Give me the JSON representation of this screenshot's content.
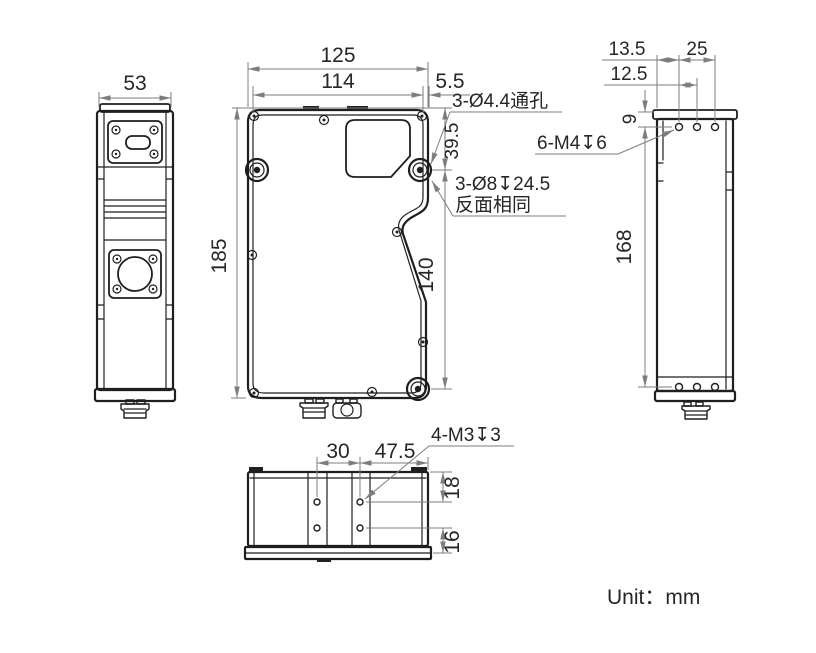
{
  "unit_label": "Unit：mm",
  "views": {
    "left": {
      "width": "53"
    },
    "front": {
      "overall_width": "125",
      "mount_hole_span": "114",
      "edge_to_hole": "5.5",
      "overall_height": "185",
      "top_to_hole": "39.5",
      "hole_span_vertical": "140",
      "callout_through_holes": "3-Ø4.4通孔",
      "callout_counterbore_line1": "3-Ø8↧24.5",
      "callout_counterbore_line2": "反面相同"
    },
    "right": {
      "edge_to_hole": "13.5",
      "hole_pitch": "12.5",
      "hole_span": "25",
      "top_to_hole": "9",
      "hole_span_vertical": "168",
      "callout_tapped": "6-M4↧6"
    },
    "bottom": {
      "hole_pitch": "30",
      "hole_to_edge": "47.5",
      "top_to_hole": "18",
      "hole_to_bottom": "16",
      "callout_tapped": "4-M3↧3"
    }
  },
  "colors": {
    "object_line": "#1f1f1f",
    "dimension_line": "#7d7d7d",
    "text": "#262626",
    "background": "#ffffff"
  }
}
